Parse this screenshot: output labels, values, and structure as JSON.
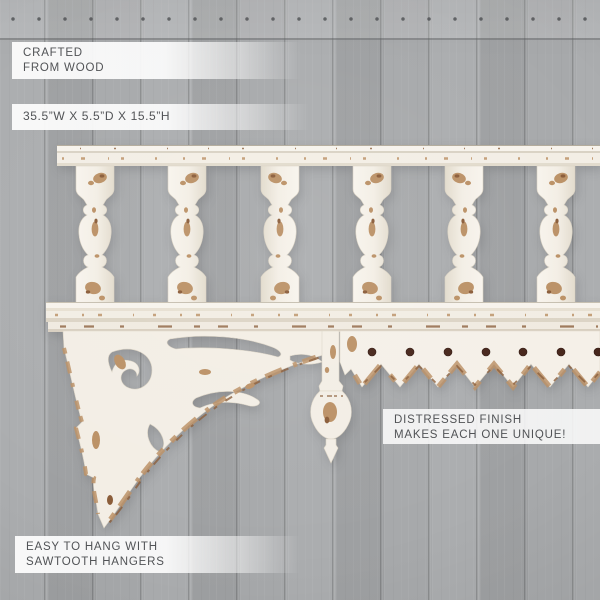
{
  "callouts": {
    "material": {
      "lines": [
        "CRAFTED",
        "FROM WOOD"
      ]
    },
    "dimensions": {
      "lines": [
        "35.5”W X 5.5”D X 15.5”H"
      ]
    },
    "finish": {
      "lines": [
        "DISTRESSED FINISH",
        "MAKES EACH ONE UNIQUE!"
      ]
    },
    "hanging": {
      "lines": [
        "EASY TO HANG WITH",
        "SAWTOOTH HANGERS"
      ]
    }
  },
  "colors": {
    "background": "#a7a9ab",
    "background_top": "#b6b7b9",
    "plank_seam": "#8e9092",
    "shelf_cream": "#f4efe7",
    "shelf_shadow": "#ddd5c6",
    "distress_tan": "#bb9166",
    "distress_dark": "#8a5c39",
    "peg_dot": "#46251a",
    "label_bg": "#fbfbfb",
    "label_text": "#515356"
  }
}
